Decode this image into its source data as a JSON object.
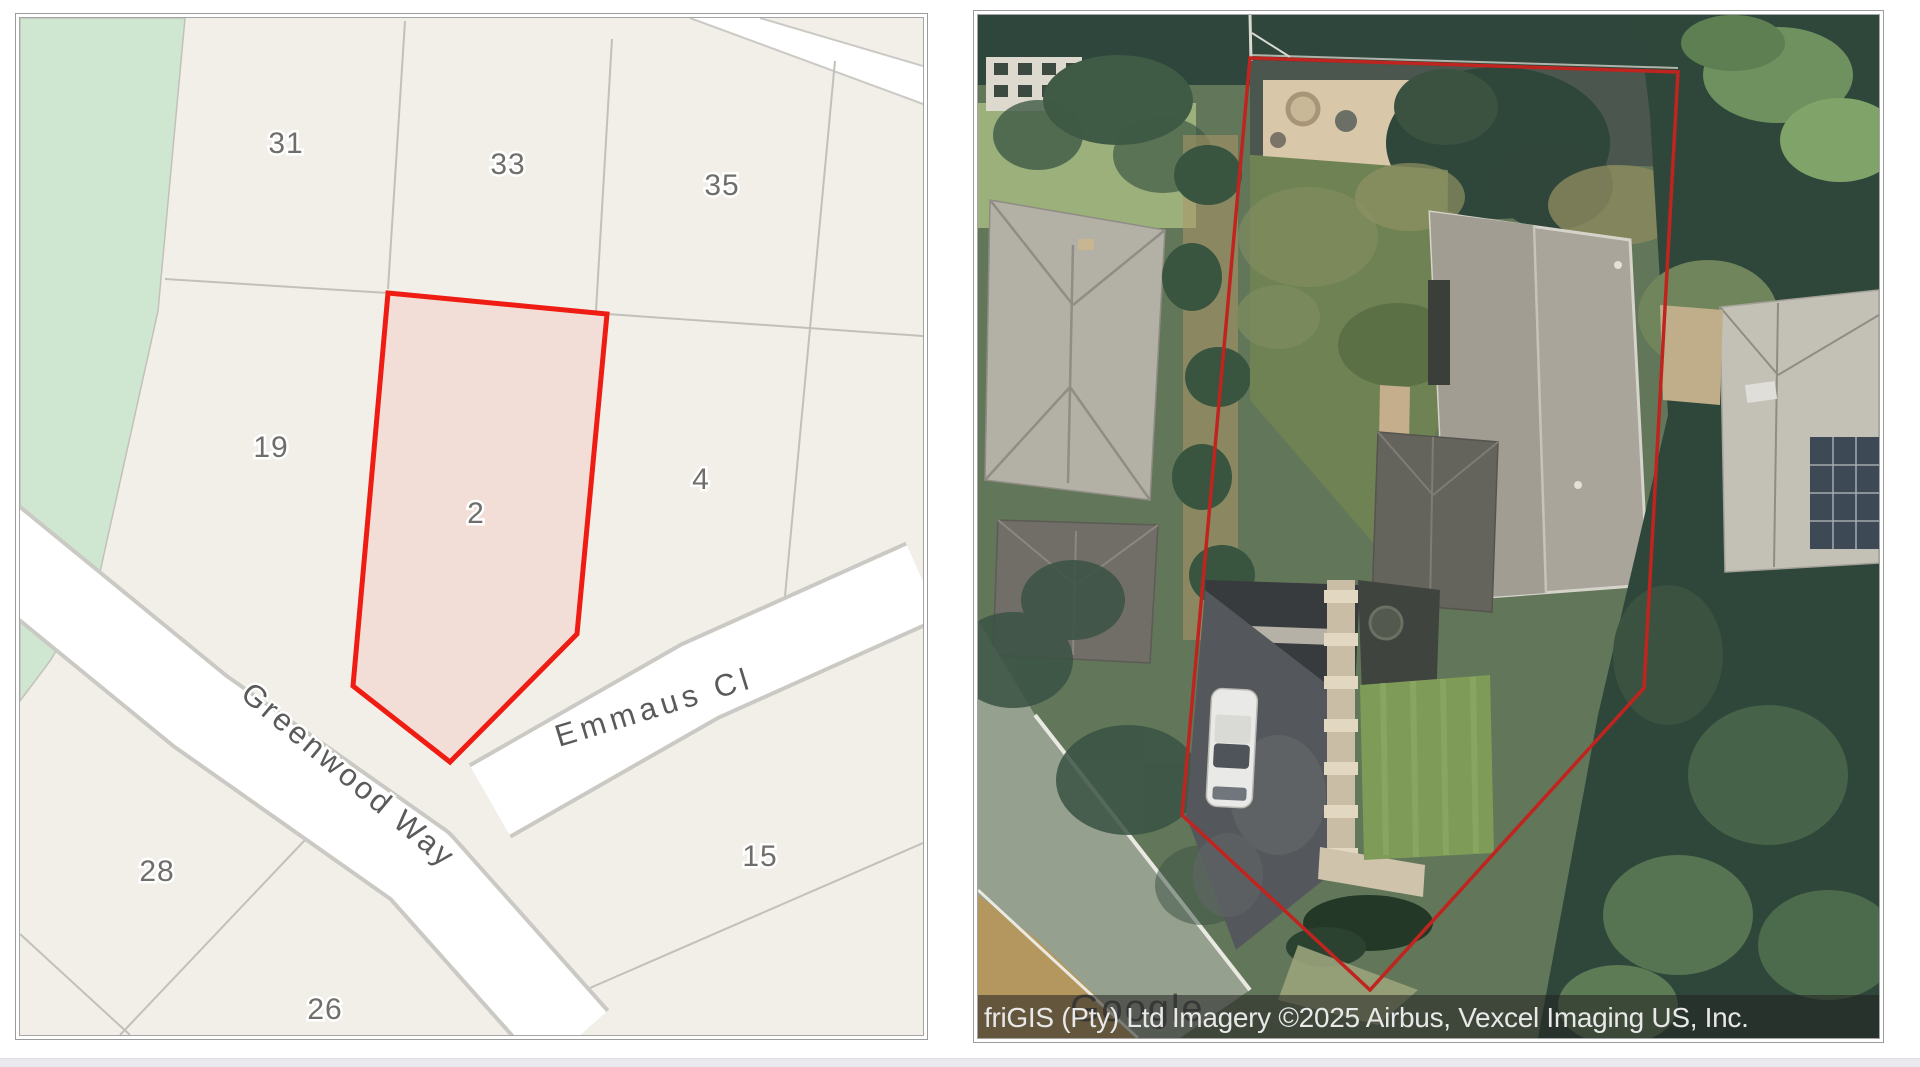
{
  "page": {
    "background": "#ffffff",
    "bottom_strip_color": "#e9e9ee"
  },
  "left_map": {
    "kind": "cadastral-parcel-map",
    "background": "#f2efe9",
    "park_color": "#cfe7d1",
    "road_color": "#ffffff",
    "parcel_line_color": "#c2c0ba",
    "highlight_color": "#ee1c12",
    "selected_parcel": "2",
    "parcels": [
      {
        "label": "31"
      },
      {
        "label": "33"
      },
      {
        "label": "35"
      },
      {
        "label": "19"
      },
      {
        "label": "2",
        "highlighted": true
      },
      {
        "label": "4"
      },
      {
        "label": "28"
      },
      {
        "label": "26"
      },
      {
        "label": "15"
      }
    ],
    "streets": [
      {
        "label": "Greenwood Way"
      },
      {
        "label": "Emmaus Cl"
      }
    ]
  },
  "right_map": {
    "kind": "satellite-imagery",
    "boundary_color": "#c0241f",
    "watermark": "Google",
    "attribution": "friGIS (Pty) Ltd Imagery ©2025 Airbus, Vexcel Imaging US, Inc."
  }
}
